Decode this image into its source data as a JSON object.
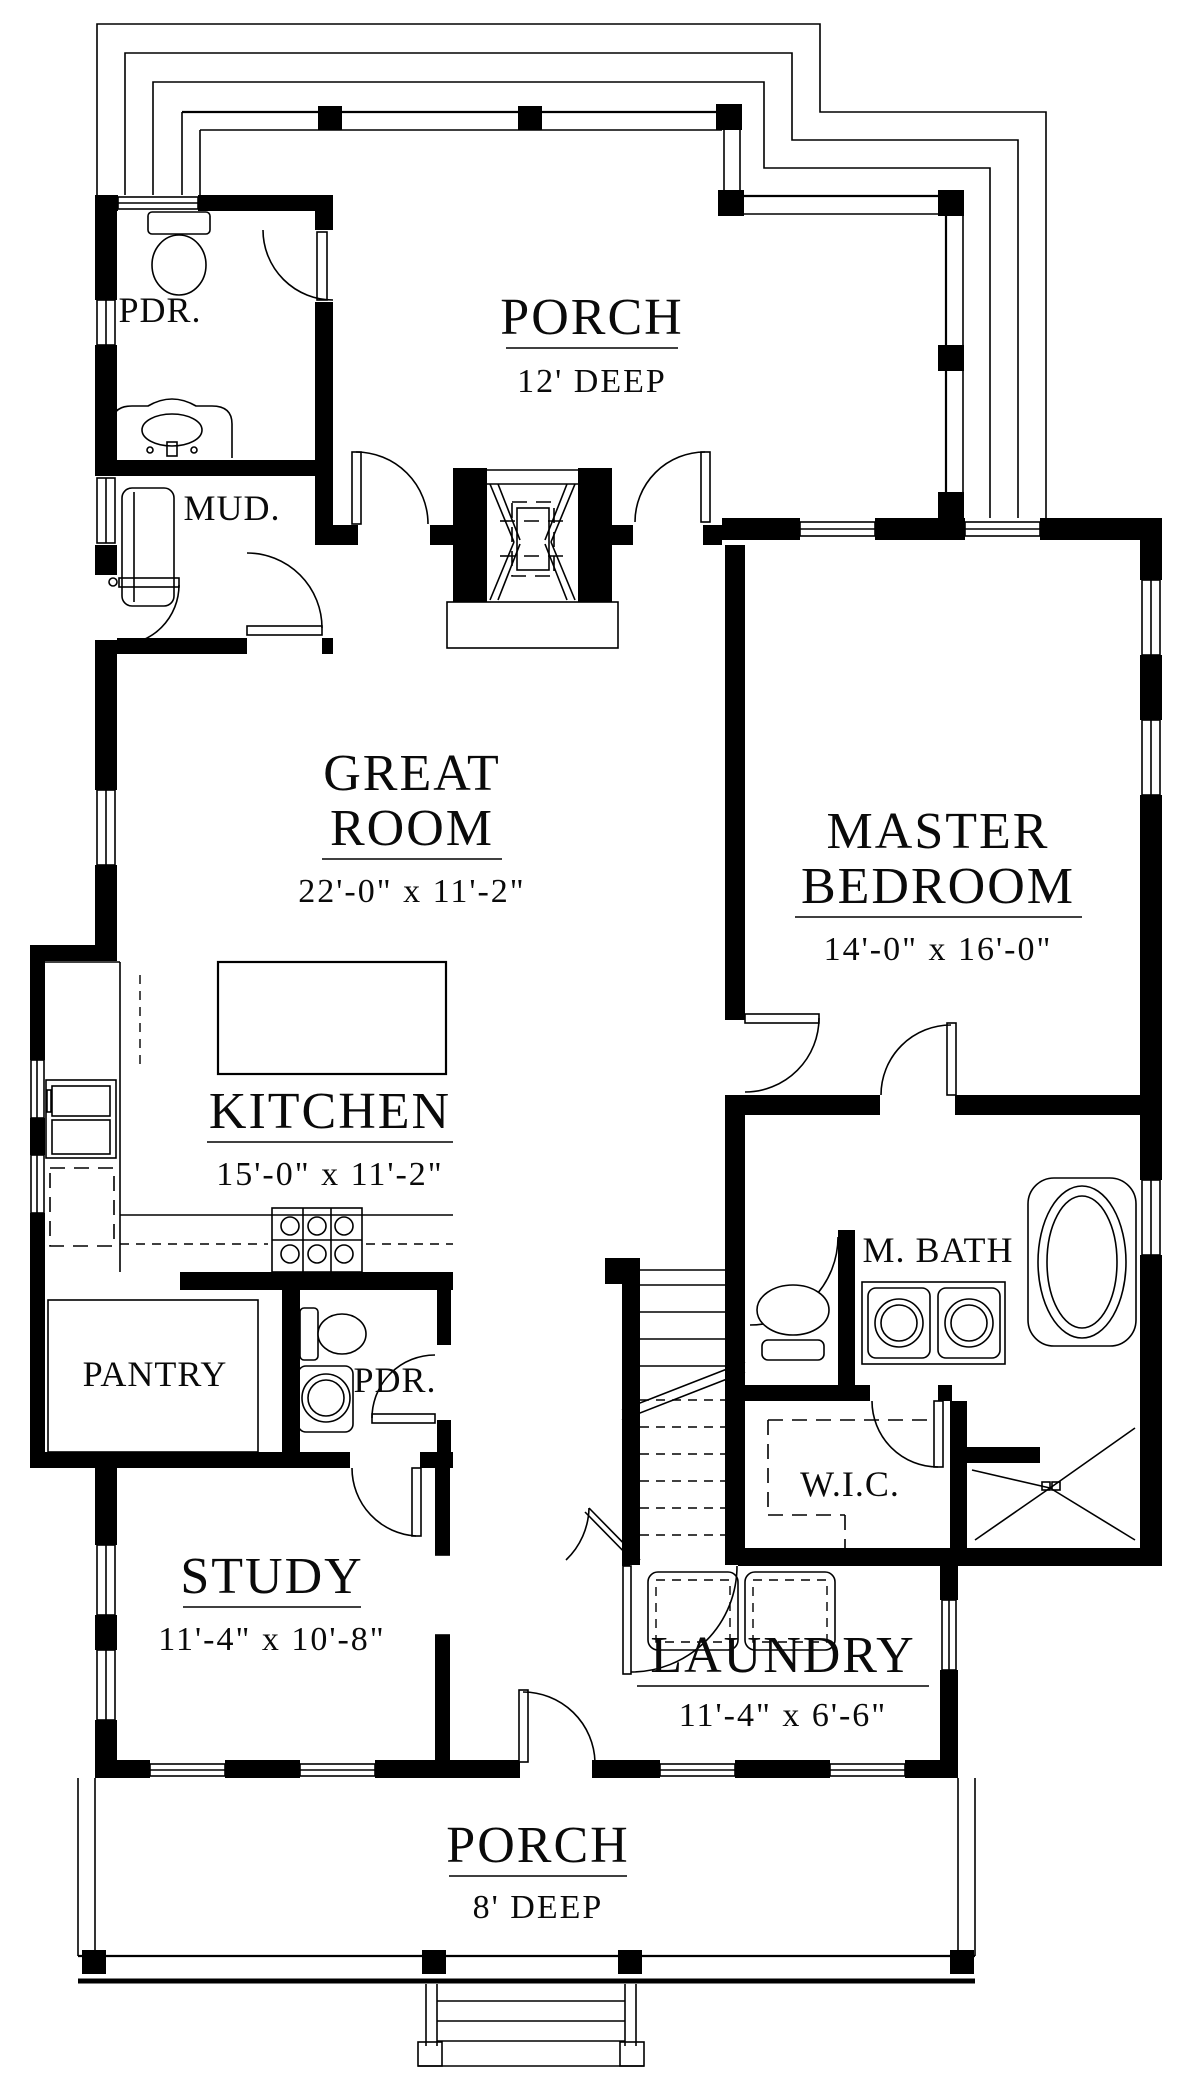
{
  "rooms": {
    "porch_top": {
      "label": "PORCH",
      "dims": "12' DEEP"
    },
    "pdr_top": {
      "label": "PDR."
    },
    "mud": {
      "label": "MUD."
    },
    "great_room": {
      "label1": "GREAT",
      "label2": "ROOM",
      "dims": "22'-0\" x 11'-2\""
    },
    "master_bedroom": {
      "label1": "MASTER",
      "label2": "BEDROOM",
      "dims": "14'-0\" x 16'-0\""
    },
    "kitchen": {
      "label": "KITCHEN",
      "dims": "15'-0\" x 11'-2\""
    },
    "master_bath": {
      "label": "M. BATH"
    },
    "pantry": {
      "label": "PANTRY"
    },
    "pdr_lower": {
      "label": "PDR."
    },
    "wic": {
      "label": "W.I.C."
    },
    "study": {
      "label": "STUDY",
      "dims": "11'-4\" x 10'-8\""
    },
    "laundry": {
      "label": "LAUNDRY",
      "dims": "11'-4\" x 6'-6\""
    },
    "porch_bottom": {
      "label": "PORCH",
      "dims": "8' DEEP"
    }
  },
  "colors": {
    "ink": "#000000",
    "paper": "#ffffff"
  }
}
